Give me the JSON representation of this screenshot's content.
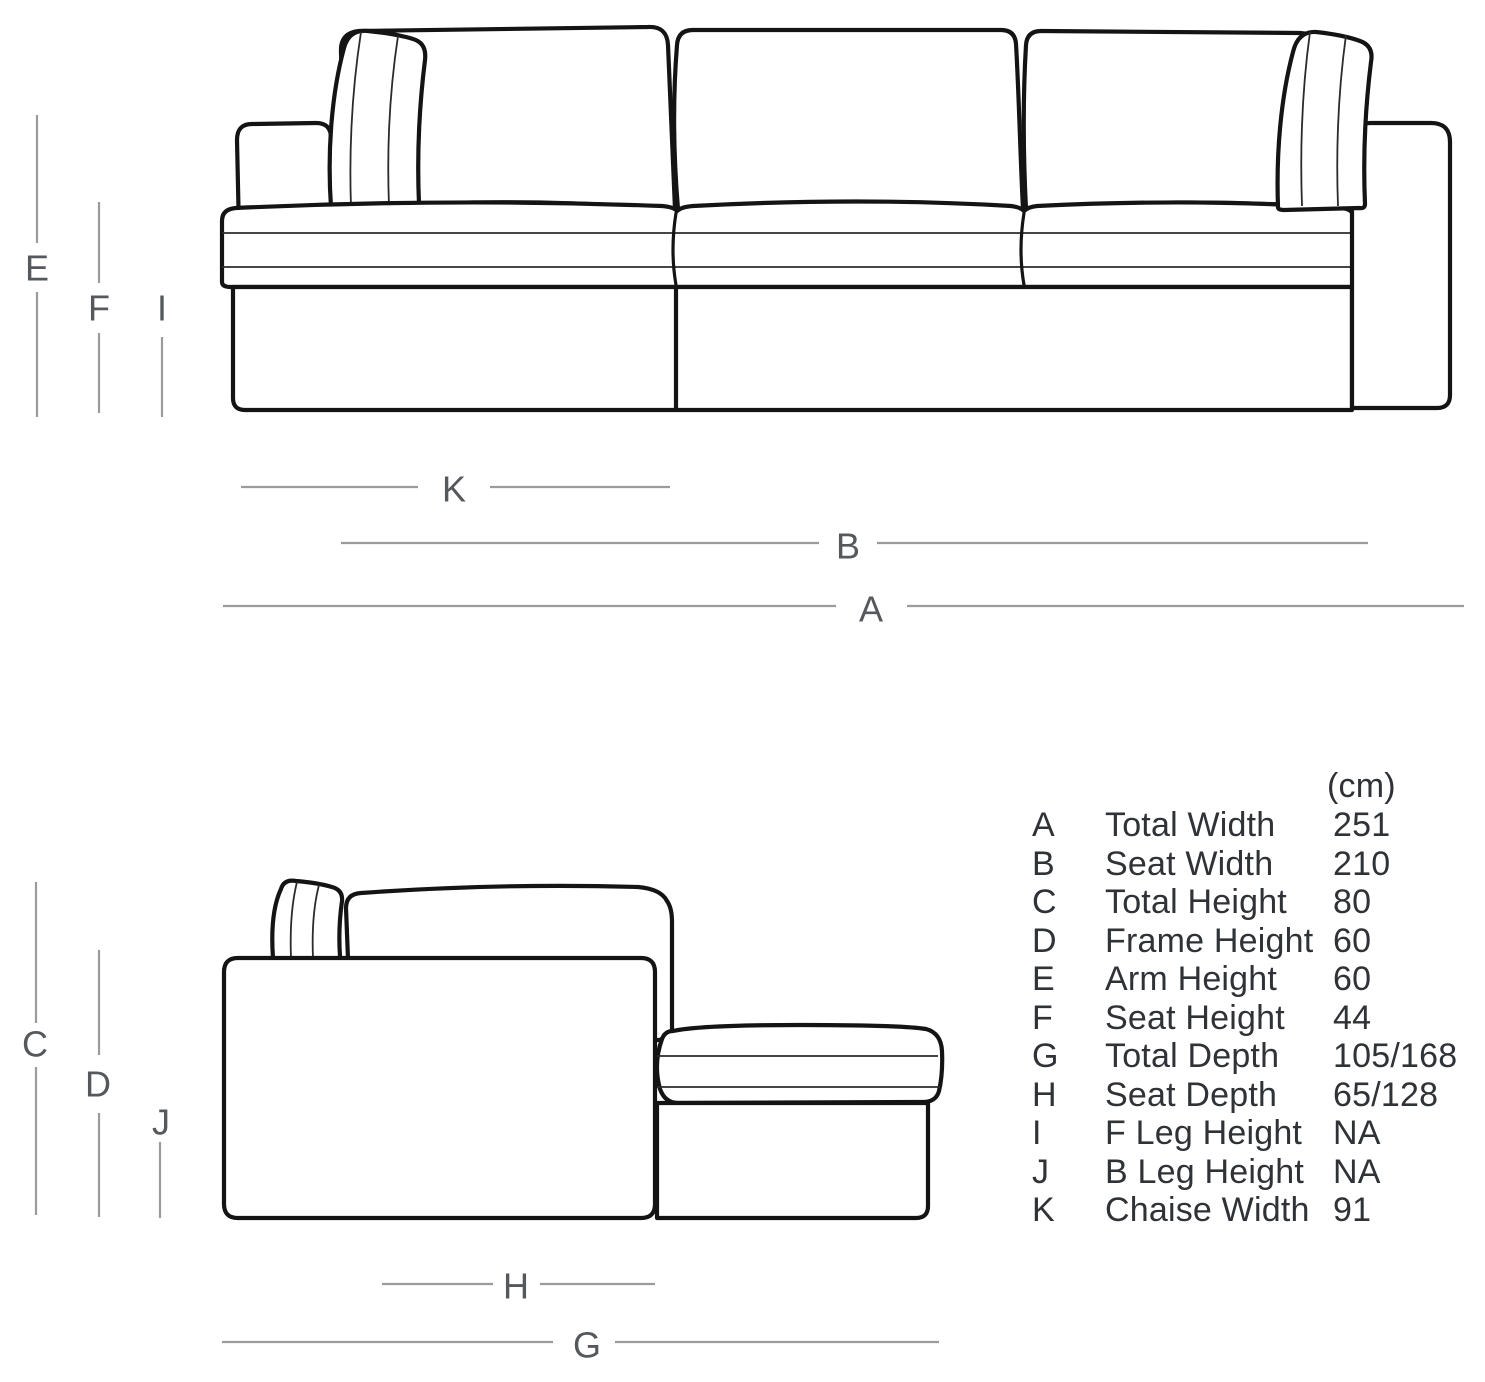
{
  "colors": {
    "outline": "#141414",
    "seam": "#2b2b2b",
    "dimension-line": "#9b9b9b",
    "dimension-label": "#55585c",
    "table-text": "#2f3236",
    "background": "#ffffff"
  },
  "labels": {
    "A": "A",
    "B": "B",
    "C": "C",
    "D": "D",
    "E": "E",
    "F": "F",
    "G": "G",
    "H": "H",
    "I": "I",
    "J": "J",
    "K": "K"
  },
  "table": {
    "unit_header": "(cm)",
    "rows": [
      {
        "letter": "A",
        "name": "Total Width",
        "value": "251"
      },
      {
        "letter": "B",
        "name": "Seat Width",
        "value": "210"
      },
      {
        "letter": "C",
        "name": "Total Height",
        "value": "80"
      },
      {
        "letter": "D",
        "name": "Frame Height",
        "value": "60"
      },
      {
        "letter": "E",
        "name": "Arm Height",
        "value": "60"
      },
      {
        "letter": "F",
        "name": "Seat Height",
        "value": "44"
      },
      {
        "letter": "G",
        "name": "Total Depth",
        "value": "105/168"
      },
      {
        "letter": "H",
        "name": "Seat Depth",
        "value": "65/128"
      },
      {
        "letter": "I",
        "name": "F Leg Height",
        "value": "NA"
      },
      {
        "letter": "J",
        "name": "B Leg Height",
        "value": "NA"
      },
      {
        "letter": "K",
        "name": "Chaise Width",
        "value": "91"
      }
    ]
  }
}
